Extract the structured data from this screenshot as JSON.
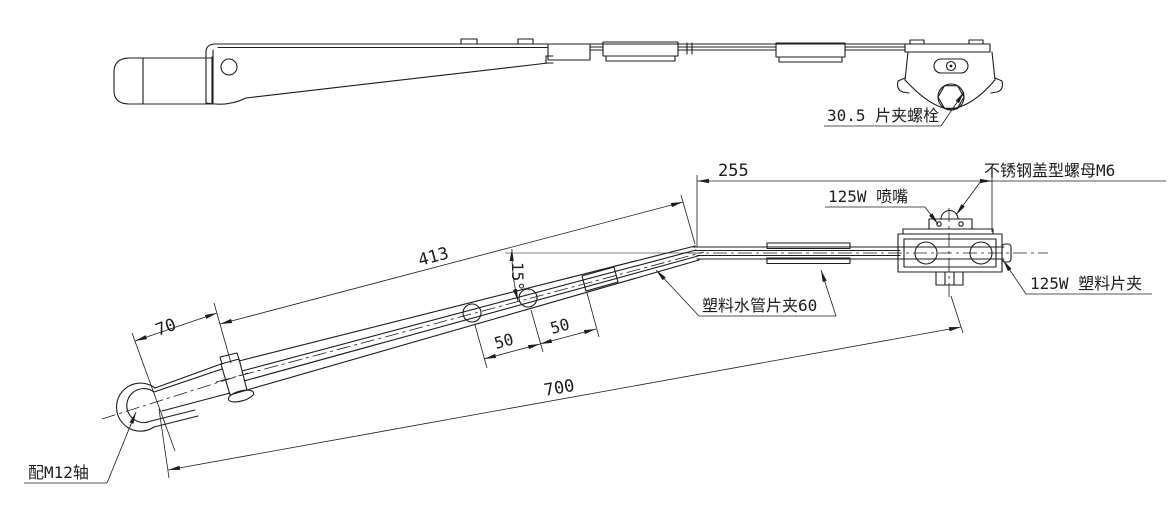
{
  "document": {
    "kind": "engineering-drawing",
    "background_color": "#ffffff",
    "line_color": "#1c1c1c"
  },
  "top_view": {
    "labels": {
      "clip_bolt": "30.5 片夹螺栓"
    }
  },
  "front_view": {
    "dimensions": {
      "head_length": "70",
      "arm_length": "413",
      "straight_length": "255",
      "overall_length": "700",
      "hole_pitch_1": "50",
      "hole_pitch_2": "50",
      "bend_angle": "15°"
    },
    "labels": {
      "shaft": "配M12轴",
      "pipe_clip": "塑料水管片夹60",
      "nozzle": "125W 喷嘴",
      "cap_nut": "不锈钢盖型螺母M6",
      "plastic_clip": "125W 塑料片夹"
    }
  }
}
